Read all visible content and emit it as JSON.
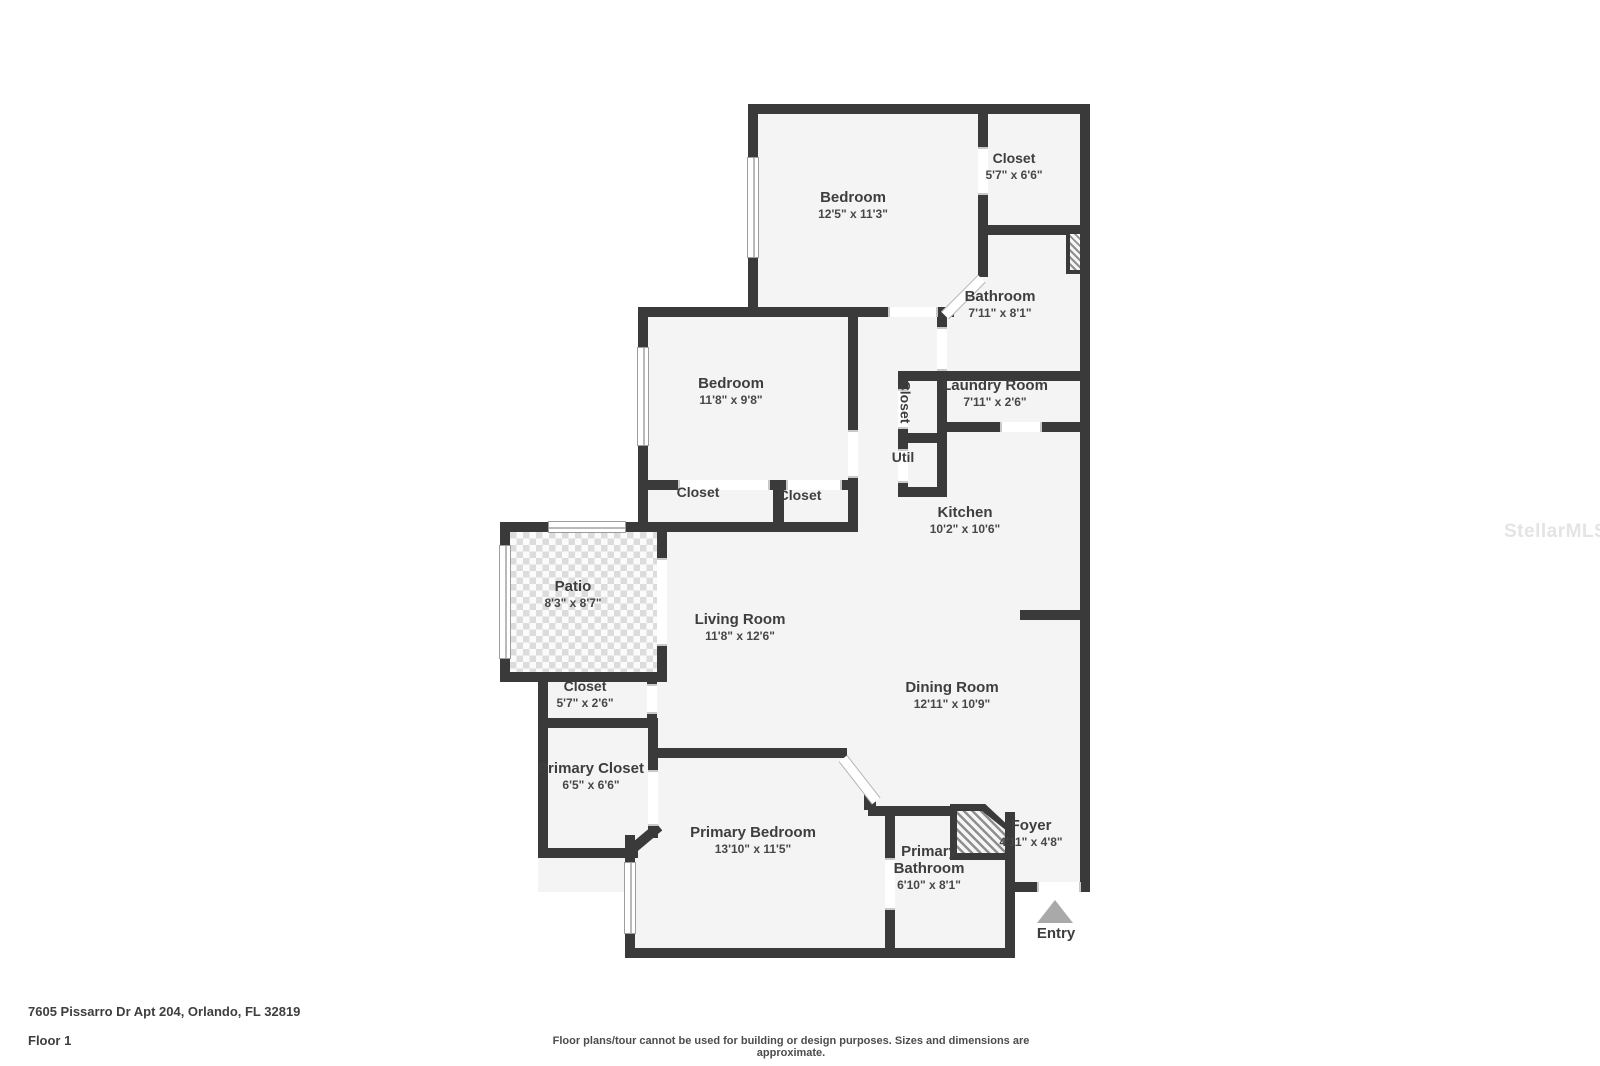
{
  "address": "7605 Pissarro Dr Apt 204, Orlando, FL 32819",
  "floor_label": "Floor 1",
  "disclaimer": "Floor plans/tour cannot be used for building or design purposes. Sizes and dimensions are approximate.",
  "watermark": "StellarMLS",
  "entry_label": "Entry",
  "colors": {
    "wall": "#3a3a3a",
    "room_fill": "#f4f4f4",
    "label_text": "#3e3e3e"
  },
  "rooms": {
    "bedroom_top": {
      "name": "Bedroom",
      "dims": "12'5\" x 11'3\""
    },
    "closet_top": {
      "name": "Closet",
      "dims": "5'7\" x 6'6\""
    },
    "bathroom": {
      "name": "Bathroom",
      "dims": "7'11\" x 8'1\""
    },
    "bedroom_mid": {
      "name": "Bedroom",
      "dims": "11'8\" x 9'8\""
    },
    "laundry": {
      "name": "Laundry Room",
      "dims": "7'11\" x 2'6\""
    },
    "closet_hall": {
      "name": "Closet"
    },
    "util": {
      "name": "Util"
    },
    "kitchen": {
      "name": "Kitchen",
      "dims": "10'2\" x 10'6\""
    },
    "closet_a": {
      "name": "Closet"
    },
    "closet_b": {
      "name": "Closet"
    },
    "patio": {
      "name": "Patio",
      "dims": "8'3\" x 8'7\""
    },
    "living": {
      "name": "Living Room",
      "dims": "11'8\" x 12'6\""
    },
    "closet_entry": {
      "name": "Closet",
      "dims": "5'7\" x 2'6\""
    },
    "dining": {
      "name": "Dining Room",
      "dims": "12'11\" x 10'9\""
    },
    "primary_closet": {
      "name": "Primary Closet",
      "dims": "6'5\" x 6'6\""
    },
    "primary_bedroom": {
      "name": "Primary Bedroom",
      "dims": "13'10\" x 11'5\""
    },
    "primary_bathroom": {
      "name": "Primary Bathroom",
      "dims": "6'10\" x 8'1\""
    },
    "foyer": {
      "name": "Foyer",
      "dims": "4'11\" x 4'8\""
    }
  }
}
